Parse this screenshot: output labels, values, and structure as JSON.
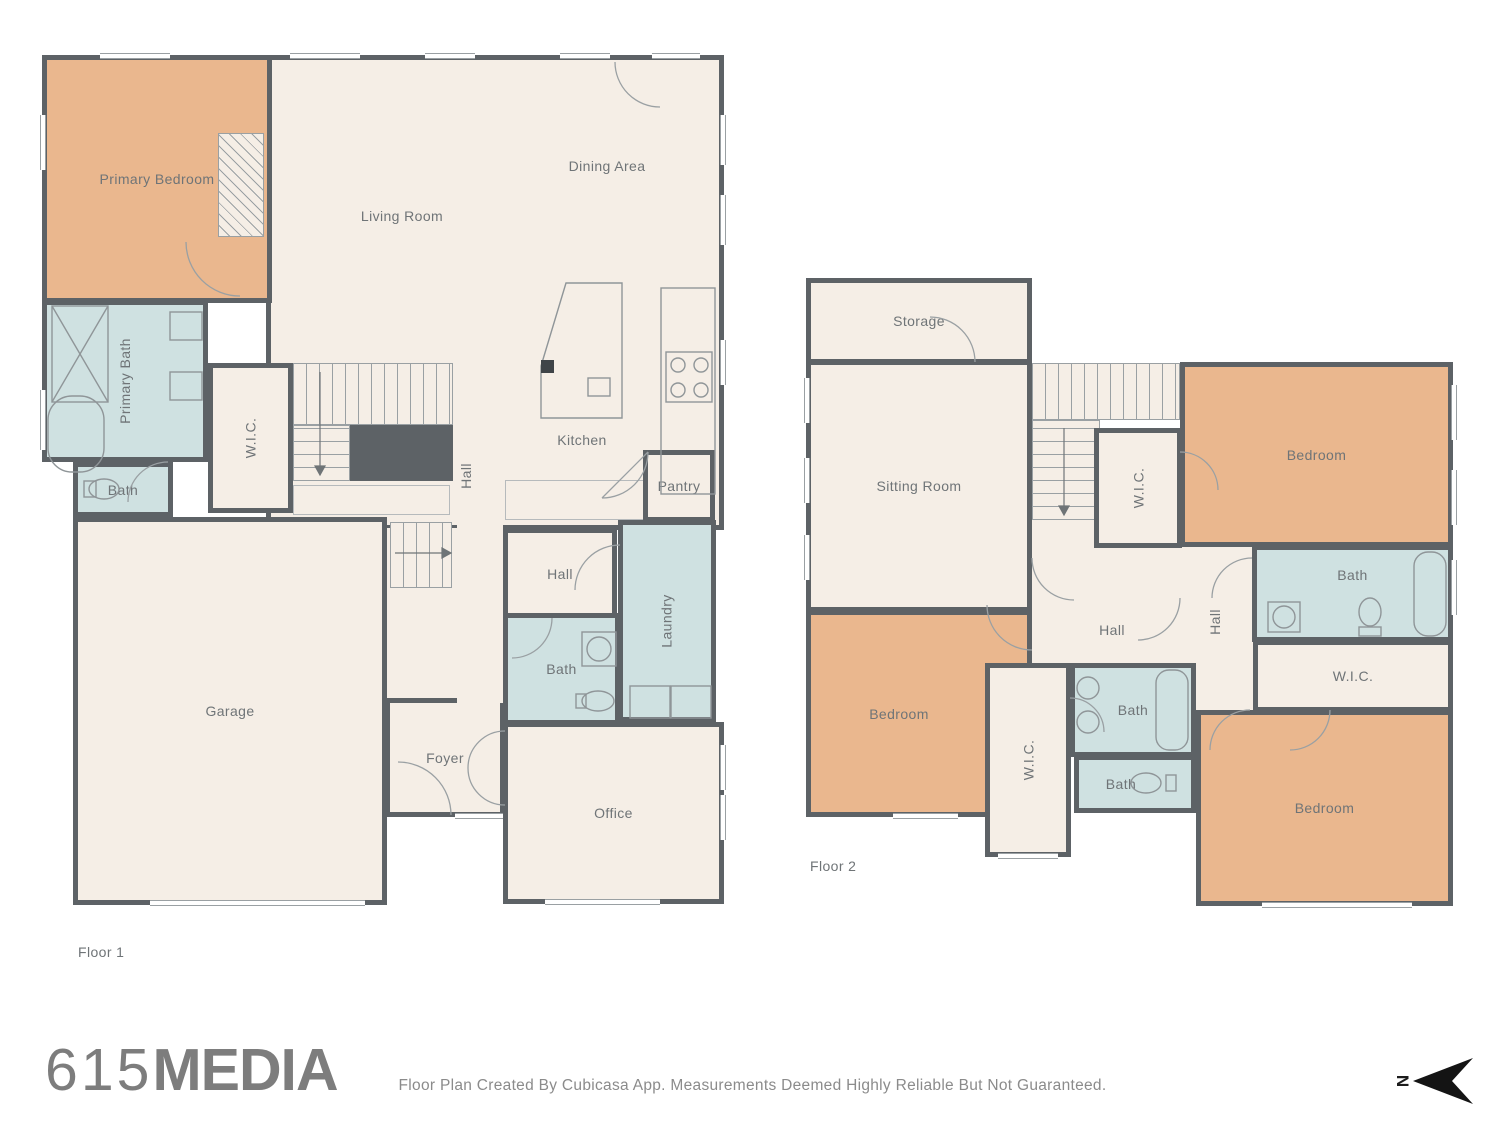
{
  "colors": {
    "wall": "#5d6266",
    "floor": "#f5eee6",
    "bedroom": "#eab78e",
    "bath": "#cfe1e1",
    "text": "#6f7477",
    "line": "#9aa0a3",
    "logo": "#7d7d7d",
    "muted": "#8b8b8b",
    "north": "#141414"
  },
  "floor1": {
    "label": "Floor 1",
    "rooms": {
      "primary_bedroom": "Primary Bedroom",
      "living_room": "Living Room",
      "dining_area": "Dining Area",
      "kitchen": "Kitchen",
      "pantry": "Pantry",
      "primary_bath": "Primary Bath",
      "bath_upper": "Bath",
      "wic": "W.I.C.",
      "hall_stairs": "Hall",
      "hall_center": "Hall",
      "laundry": "Laundry",
      "bath_center": "Bath",
      "garage": "Garage",
      "foyer": "Foyer",
      "office": "Office"
    }
  },
  "floor2": {
    "label": "Floor 2",
    "rooms": {
      "storage": "Storage",
      "sitting_room": "Sitting Room",
      "wic_top": "W.I.C.",
      "bedroom_ne": "Bedroom",
      "bath_ne": "Bath",
      "hall_center": "Hall",
      "hall_east": "Hall",
      "wic_east": "W.I.C.",
      "bedroom_west": "Bedroom",
      "wic_center": "W.I.C.",
      "bath_center": "Bath",
      "bath_small": "Bath",
      "bedroom_se": "Bedroom"
    }
  },
  "footer": {
    "logo_prefix": "615",
    "logo_suffix": "MEDIA",
    "disclaimer": "Floor Plan Created By Cubicasa App. Measurements Deemed Highly Reliable But Not Guaranteed.",
    "north_label": "N"
  }
}
